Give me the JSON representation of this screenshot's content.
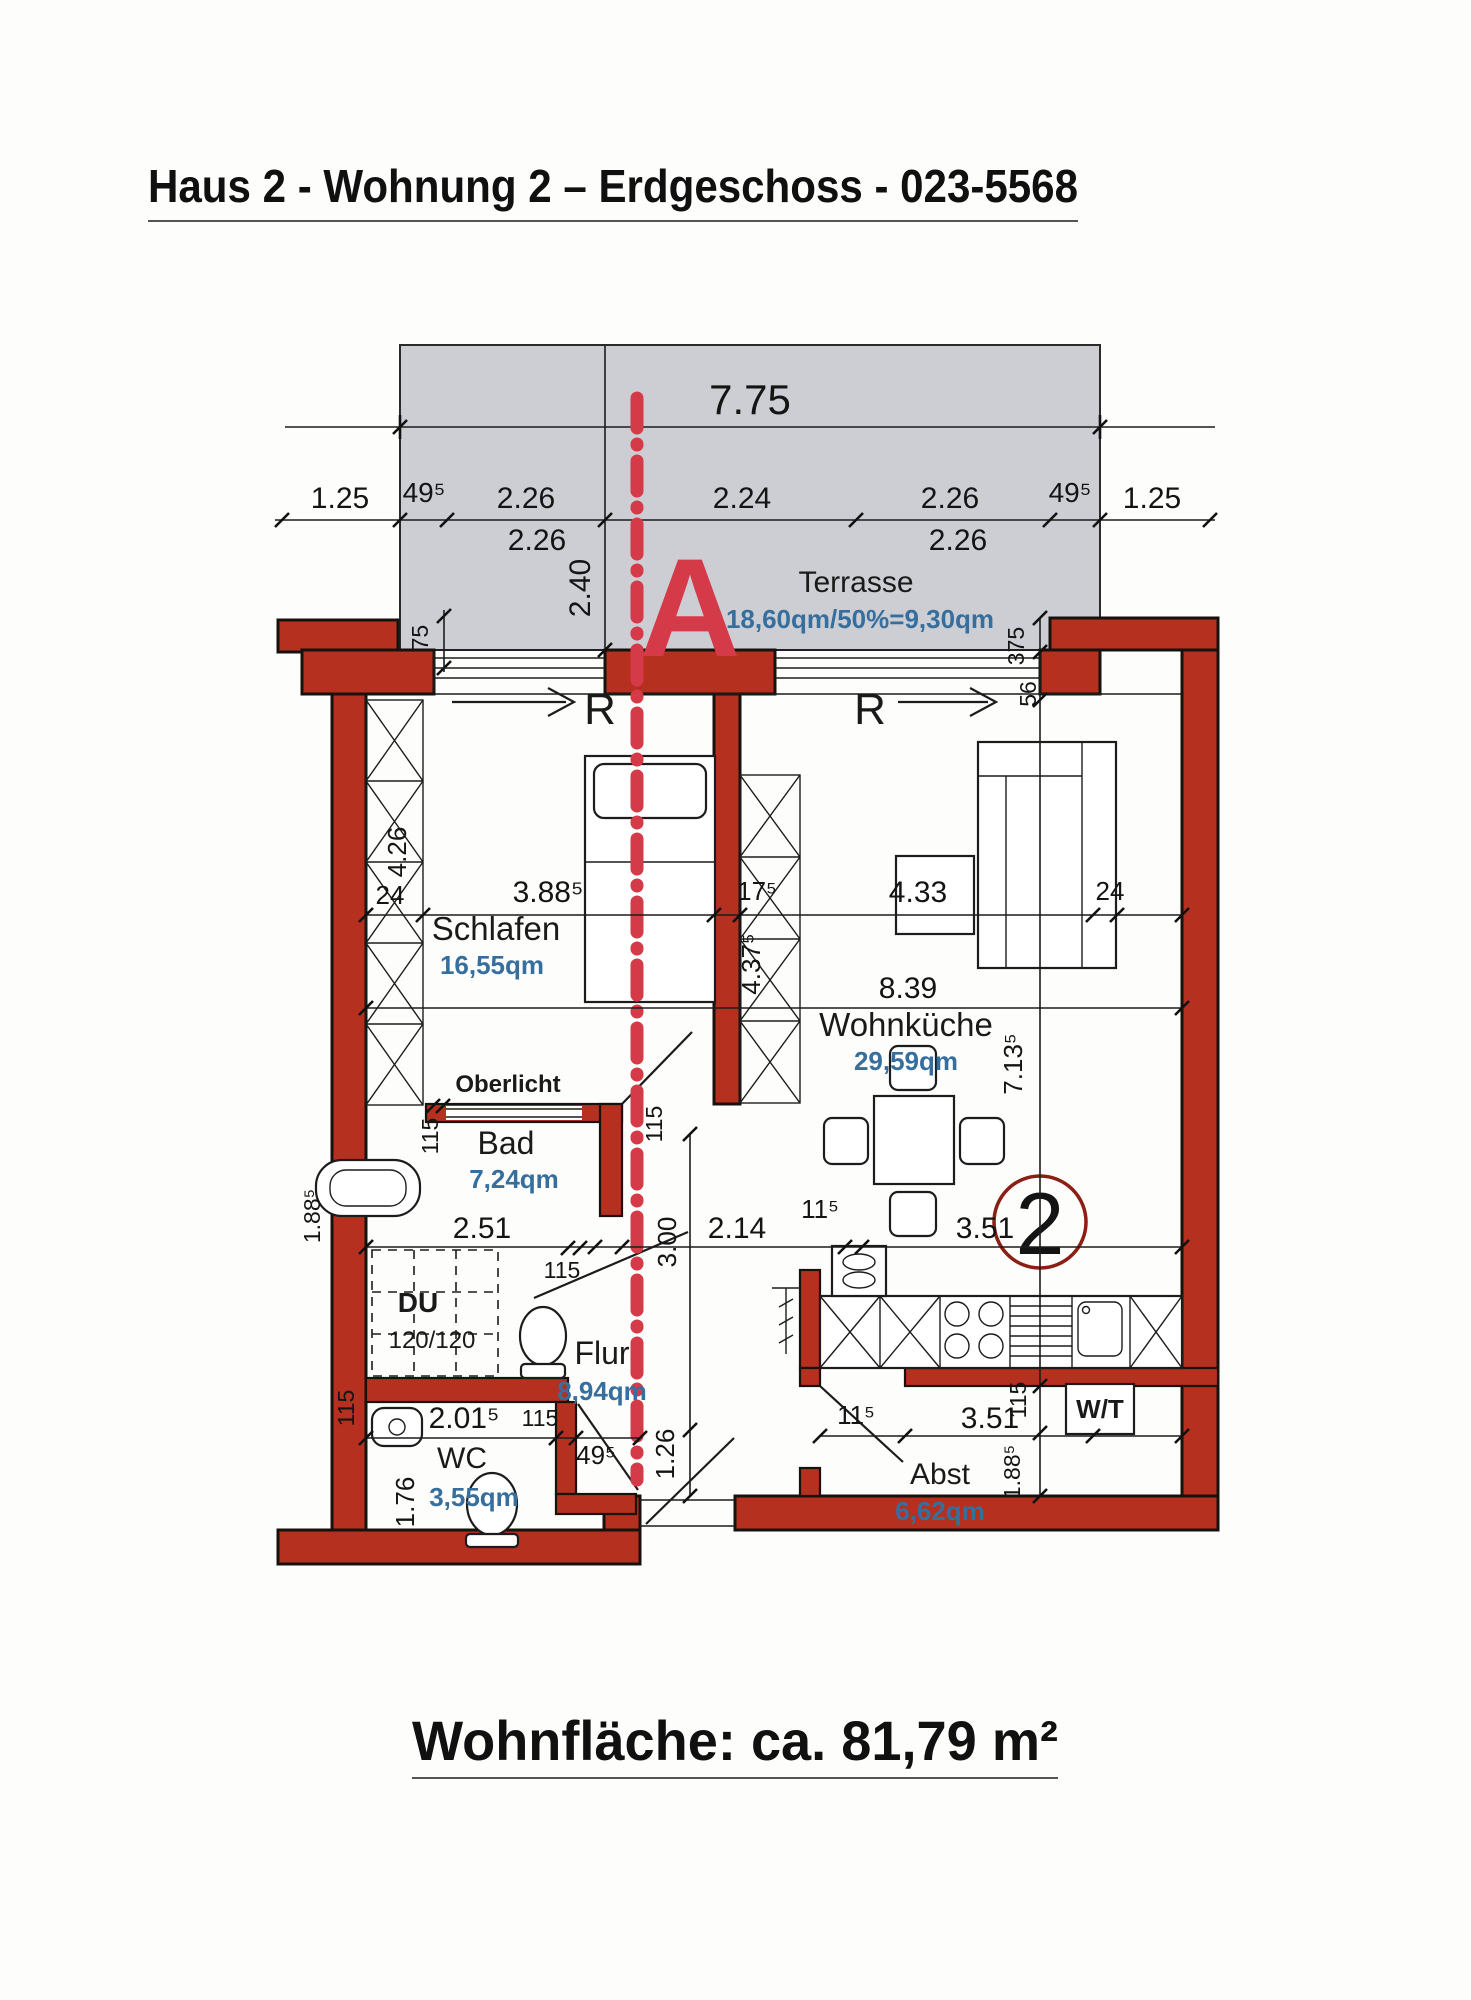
{
  "title": "Haus 2 - Wohnung 2 – Erdgeschoss - 023-5568",
  "footer": "Wohnfläche: ca. 81,79 m²",
  "colors": {
    "wall_red": "#b5301f",
    "section_red": "#d53a49",
    "area_blue": "#366f9e",
    "terrace_gray": "#cdced3",
    "circle_maroon": "#8c1f15"
  },
  "markers": {
    "section": "A",
    "apartment_number": "2",
    "r_left": "R",
    "r_right": "R"
  },
  "rooms": {
    "terrasse": {
      "name": "Terrasse",
      "area": "18,60qm/50%=9,30qm"
    },
    "schlafen": {
      "name": "Schlafen",
      "area": "16,55qm"
    },
    "wohnkueche": {
      "name": "Wohnküche",
      "area": "29,59qm"
    },
    "bad": {
      "name": "Bad",
      "area": "7,24qm"
    },
    "flur": {
      "name": "Flur",
      "area": "8,94qm"
    },
    "wc": {
      "name": "WC",
      "area": "3,55qm"
    },
    "abst": {
      "name": "Abst",
      "area": "6,62qm"
    },
    "du": {
      "name": "DU",
      "size": "120/120"
    },
    "wt": {
      "name": "W/T"
    },
    "oberlicht": {
      "name": "Oberlicht"
    }
  },
  "dims": {
    "total": "7.75",
    "left_margin": "1.25",
    "left_wall": "49⁵",
    "seg1_top": "2.26",
    "seg1_bot": "2.26",
    "seg2": "2.24",
    "seg3_top": "2.26",
    "seg3_bot": "2.26",
    "right_wall": "49⁵",
    "right_margin": "1.25",
    "terrace_depth": "2.40",
    "wall375_left": "375",
    "wall375_right": "375",
    "wall56": "56",
    "wardrobe_len": "4.26",
    "wall24_left": "24",
    "schlafen_w": "3.88⁵",
    "shaft_w": "17⁵",
    "shaft_len": "4.37⁵",
    "kueche_w": "4.33",
    "wall24_right": "24",
    "inner_w": "8.39",
    "kueche_len": "7.13⁵",
    "basin_len": "1.88⁵",
    "bad_side": "115",
    "bad_w": "2.51",
    "bad_door": "115",
    "flur_side": "115",
    "flur_len": "3.00",
    "flur_w": "2.14",
    "flur_door": "11⁵",
    "kitchen_w": "3.51",
    "flur_entry": "1.26",
    "wc_side": "115",
    "wc_w": "2.01⁵",
    "wc_door": "115",
    "wc_len": "1.76",
    "wc_gap": "49⁵",
    "abst_door": "11⁵",
    "abst_w": "3.51",
    "wt_side": "115",
    "abst_len": "1.88⁵"
  }
}
